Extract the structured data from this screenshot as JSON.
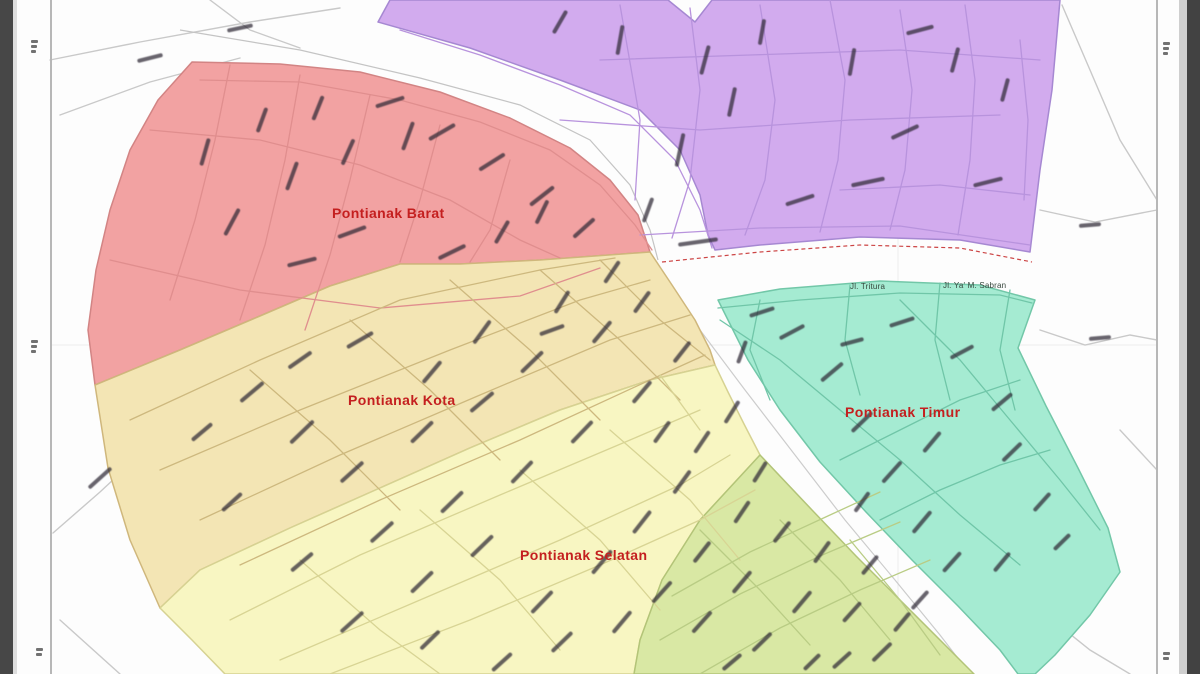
{
  "map": {
    "title": "Pontianak district map",
    "label_color": "#c41f1f",
    "street_label_color": "#35453b",
    "background_color": "#fdfdfd",
    "river_color": "#fdfdfd",
    "regions": [
      {
        "key": "north",
        "label": null,
        "fill": "#d2abee",
        "stroke": "#a688d2",
        "road_color": "#b893dd"
      },
      {
        "key": "west",
        "label": "Pontianak Barat",
        "fill": "#f2a2a2",
        "stroke": "#d28484",
        "road_color": "#e08e8e"
      },
      {
        "key": "central",
        "label": "Pontianak Kota",
        "fill": "#f3e5b4",
        "stroke": "#cfb77c",
        "road_color": "#cdb87e"
      },
      {
        "key": "south",
        "label": "Pontianak Selatan",
        "fill": "#f8f6c2",
        "stroke": "#d6d292",
        "road_color": "#d8d494"
      },
      {
        "key": "southeast",
        "label": null,
        "fill": "#d9e8a4",
        "stroke": "#b3c478",
        "road_color": "#b9cc84"
      },
      {
        "key": "east",
        "label": "Pontianak Timur",
        "fill": "#a5ebd2",
        "stroke": "#72c7a8",
        "road_color": "#70c6a8"
      }
    ],
    "street_labels": [
      {
        "text": "Jl. Tritura",
        "x": 868,
        "y": 293
      },
      {
        "text": "Jl. Ya' M. Sabran",
        "x": 977,
        "y": 292
      }
    ]
  },
  "map_art": {
    "grid_lines": [
      {
        "pts": "898,0 898,674"
      },
      {
        "pts": "50,345 1156,345"
      }
    ],
    "river_lines": [
      {
        "color": "#c4c4c4",
        "dash": "",
        "pts": "180,30 300,50 420,78 520,105 590,140 630,185 650,230 658,260"
      },
      {
        "color": "#cccccc",
        "dash": "",
        "pts": "662,280 700,330 745,390 795,455 845,520 895,580 940,635 970,674"
      },
      {
        "color": "#cc4444",
        "dash": "4 3",
        "pts": "662,262 760,252 860,245 960,248 1032,262"
      }
    ],
    "white_roads": [
      "50,60 140,42 250,22 340,8",
      "60,115 150,82 240,58",
      "210,0 250,30 300,48",
      "1062,5 1090,70 1120,140 1157,200",
      "1040,210 1095,222 1157,210",
      "1040,330 1085,345 1130,335 1157,340",
      "1120,430 1157,470",
      "53,533 100,492 143,452",
      "150,462 230,560 300,674",
      "60,620 120,674",
      "1040,610 1090,650 1130,674"
    ],
    "region_roads": [
      {
        "region": 0,
        "lines": [
          "400,30 480,55 560,85 630,115 675,160 700,210 712,248",
          "640,235 760,228 900,226 1030,245",
          "620,5 640,120 635,200",
          "690,8 700,90 690,180 672,238",
          "760,5 775,100 765,180 745,235",
          "830,0 845,80 838,160 820,232",
          "900,10 912,90 905,170 890,230",
          "965,5 975,80 970,160 958,235",
          "1020,40 1028,120 1024,200",
          "560,120 700,130 850,120 1000,115",
          "600,60 750,55 900,50 1040,60",
          "840,190 940,185 1030,195"
        ]
      },
      {
        "region": 1,
        "lines": [
          "200,80 300,82 400,100 480,122 550,150 600,185 635,225 652,250",
          "150,130 260,140 360,165 450,200 520,240 560,258",
          "230,65 215,140 195,220 170,300",
          "300,75 285,160 265,245 240,320",
          "370,95 350,180 330,255 305,330",
          "440,125 420,200 400,262",
          "510,160 490,230 470,262",
          "110,260 240,290 380,308 520,296 600,268"
        ]
      },
      {
        "region": 2,
        "lines": [
          "130,420 260,360 400,300 540,270 615,258",
          "160,470 300,410 450,350 580,300 650,280",
          "200,520 340,455 480,395 610,340 690,315",
          "240,565 380,500 520,440 650,380 705,355",
          "250,370 330,440 400,510",
          "350,320 430,390 500,460",
          "450,280 530,350 600,420",
          "540,270 620,340 680,400",
          "600,260 660,320 710,360"
        ]
      },
      {
        "region": 3,
        "lines": [
          "230,620 360,555 500,495 630,440 700,410",
          "280,660 420,600 560,540 680,485 730,455",
          "330,674 470,620 600,565 700,520 755,490",
          "300,560 380,630 440,674",
          "420,510 500,580 560,650",
          "520,470 600,540 660,610",
          "610,430 690,500 740,560",
          "660,375 700,430"
        ]
      },
      {
        "region": 4,
        "lines": [
          "672,596 750,552 830,515 880,492",
          "660,640 740,594 820,556 900,522",
          "700,674 780,628 860,590 930,560",
          "700,530 760,590 810,645",
          "780,520 840,580 890,640",
          "850,540 900,600 940,655"
        ]
      },
      {
        "region": 5,
        "lines": [
          "718,308 800,300 900,293 1000,295 1032,303",
          "720,320 780,360 840,410 900,460 960,515 1020,565",
          "760,300 750,350 770,400",
          "850,285 845,340 860,395",
          "940,283 935,340 950,400",
          "1010,290 1000,350 1015,410",
          "900,300 960,360 1010,420 1060,480 1100,530",
          "840,460 900,430 960,400 1020,380",
          "880,520 940,490 1000,465 1050,450"
        ]
      }
    ],
    "label_dashes": [
      [
        620,
        40,
        -80,
        30
      ],
      [
        680,
        150,
        -78,
        34
      ],
      [
        705,
        60,
        -75,
        30
      ],
      [
        560,
        22,
        -60,
        26
      ],
      [
        852,
        62,
        -80,
        28
      ],
      [
        905,
        132,
        -25,
        30
      ],
      [
        955,
        60,
        -75,
        26
      ],
      [
        868,
        182,
        -12,
        34
      ],
      [
        988,
        182,
        -14,
        30
      ],
      [
        762,
        32,
        -80,
        26
      ],
      [
        800,
        200,
        -18,
        30
      ],
      [
        732,
        102,
        -78,
        30
      ],
      [
        648,
        210,
        -70,
        26
      ],
      [
        920,
        30,
        -15,
        28
      ],
      [
        1005,
        90,
        -75,
        24
      ],
      [
        698,
        242,
        -8,
        40
      ],
      [
        232,
        222,
        -62,
        30
      ],
      [
        292,
        176,
        -70,
        30
      ],
      [
        348,
        152,
        -66,
        28
      ],
      [
        408,
        136,
        -70,
        30
      ],
      [
        352,
        232,
        -20,
        30
      ],
      [
        452,
        252,
        -26,
        30
      ],
      [
        502,
        232,
        -60,
        26
      ],
      [
        542,
        212,
        -64,
        26
      ],
      [
        302,
        262,
        -14,
        30
      ],
      [
        205,
        152,
        -74,
        28
      ],
      [
        390,
        102,
        -18,
        30
      ],
      [
        442,
        132,
        -30,
        30
      ],
      [
        492,
        162,
        -32,
        30
      ],
      [
        542,
        196,
        -38,
        30
      ],
      [
        584,
        228,
        -42,
        28
      ],
      [
        262,
        120,
        -70,
        26
      ],
      [
        318,
        108,
        -68,
        26
      ],
      [
        252,
        392,
        -40,
        30
      ],
      [
        302,
        432,
        -44,
        32
      ],
      [
        352,
        472,
        -42,
        30
      ],
      [
        422,
        432,
        -44,
        30
      ],
      [
        482,
        402,
        -40,
        30
      ],
      [
        532,
        362,
        -44,
        30
      ],
      [
        602,
        332,
        -50,
        28
      ],
      [
        642,
        302,
        -54,
        26
      ],
      [
        382,
        532,
        -42,
        30
      ],
      [
        302,
        562,
        -40,
        28
      ],
      [
        452,
        502,
        -44,
        30
      ],
      [
        522,
        472,
        -46,
        30
      ],
      [
        582,
        432,
        -46,
        30
      ],
      [
        642,
        392,
        -50,
        28
      ],
      [
        682,
        352,
        -52,
        26
      ],
      [
        562,
        302,
        -58,
        26
      ],
      [
        612,
        272,
        -56,
        26
      ],
      [
        482,
        332,
        -54,
        28
      ],
      [
        432,
        372,
        -50,
        28
      ],
      [
        202,
        432,
        -40,
        26
      ],
      [
        232,
        502,
        -42,
        26
      ],
      [
        662,
        432,
        -54,
        26
      ],
      [
        552,
        330,
        -20,
        26
      ],
      [
        360,
        340,
        -30,
        30
      ],
      [
        300,
        360,
        -35,
        28
      ],
      [
        352,
        622,
        -42,
        30
      ],
      [
        422,
        582,
        -44,
        30
      ],
      [
        482,
        546,
        -44,
        30
      ],
      [
        542,
        602,
        -46,
        30
      ],
      [
        602,
        562,
        -50,
        30
      ],
      [
        642,
        522,
        -52,
        28
      ],
      [
        682,
        482,
        -54,
        28
      ],
      [
        702,
        442,
        -56,
        26
      ],
      [
        732,
        412,
        -58,
        26
      ],
      [
        562,
        642,
        -44,
        28
      ],
      [
        622,
        622,
        -50,
        28
      ],
      [
        502,
        662,
        -42,
        26
      ],
      [
        662,
        592,
        -48,
        28
      ],
      [
        702,
        552,
        -52,
        26
      ],
      [
        742,
        512,
        -56,
        26
      ],
      [
        760,
        472,
        -58,
        24
      ],
      [
        430,
        640,
        -44,
        26
      ],
      [
        702,
        622,
        -48,
        28
      ],
      [
        742,
        582,
        -50,
        28
      ],
      [
        762,
        642,
        -44,
        26
      ],
      [
        802,
        602,
        -50,
        28
      ],
      [
        822,
        552,
        -54,
        26
      ],
      [
        852,
        612,
        -48,
        26
      ],
      [
        882,
        652,
        -44,
        26
      ],
      [
        782,
        532,
        -52,
        26
      ],
      [
        842,
        660,
        -42,
        24
      ],
      [
        902,
        622,
        -50,
        24
      ],
      [
        732,
        662,
        -40,
        24
      ],
      [
        812,
        662,
        -44,
        22
      ],
      [
        870,
        565,
        -50,
        24
      ],
      [
        920,
        600,
        -48,
        24
      ],
      [
        792,
        332,
        -28,
        28
      ],
      [
        832,
        372,
        -40,
        28
      ],
      [
        862,
        422,
        -44,
        28
      ],
      [
        892,
        472,
        -48,
        28
      ],
      [
        922,
        522,
        -50,
        28
      ],
      [
        952,
        562,
        -48,
        26
      ],
      [
        902,
        322,
        -18,
        26
      ],
      [
        962,
        352,
        -28,
        26
      ],
      [
        1002,
        402,
        -40,
        26
      ],
      [
        1012,
        452,
        -44,
        26
      ],
      [
        1042,
        502,
        -48,
        24
      ],
      [
        932,
        442,
        -50,
        26
      ],
      [
        862,
        502,
        -54,
        24
      ],
      [
        1002,
        562,
        -50,
        24
      ],
      [
        1062,
        542,
        -44,
        22
      ],
      [
        762,
        312,
        -18,
        26
      ],
      [
        742,
        352,
        -70,
        24
      ],
      [
        852,
        342,
        -15,
        24
      ],
      [
        100,
        478,
        -42,
        30
      ],
      [
        150,
        58,
        -14,
        26
      ],
      [
        240,
        28,
        -12,
        26
      ],
      [
        1090,
        225,
        -5,
        22
      ],
      [
        1100,
        338,
        -5,
        22
      ]
    ]
  }
}
